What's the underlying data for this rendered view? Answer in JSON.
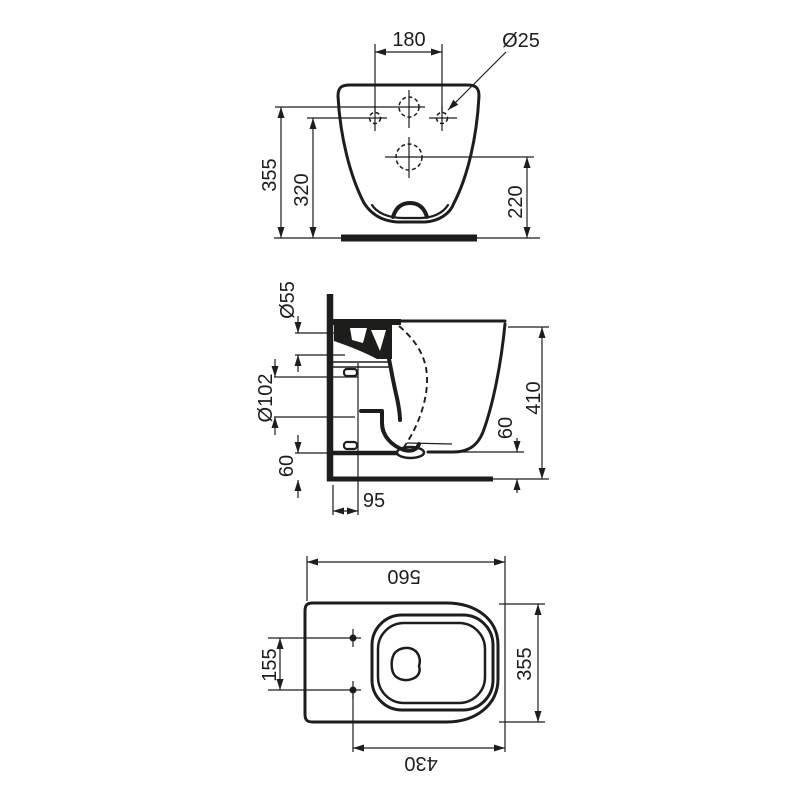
{
  "drawing": {
    "background": "#ffffff",
    "ink_color": "#1d1d1b",
    "front_view": {
      "hole_spacing": "180",
      "fixing_hole_diameter": "Ø25",
      "inlet_height": "355",
      "fixing_height": "320",
      "outlet_height": "220"
    },
    "side_view": {
      "inlet_diameter": "Ø55",
      "outlet_diameter": "Ø102",
      "clearance_left": "60",
      "outlet_wall_distance": "95",
      "total_height": "410",
      "rim_floor_clearance": "60"
    },
    "plan_view": {
      "overall_depth": "560",
      "fixing_hole_spacing": "155",
      "overall_width": "355",
      "front_to_fixing": "430"
    }
  }
}
